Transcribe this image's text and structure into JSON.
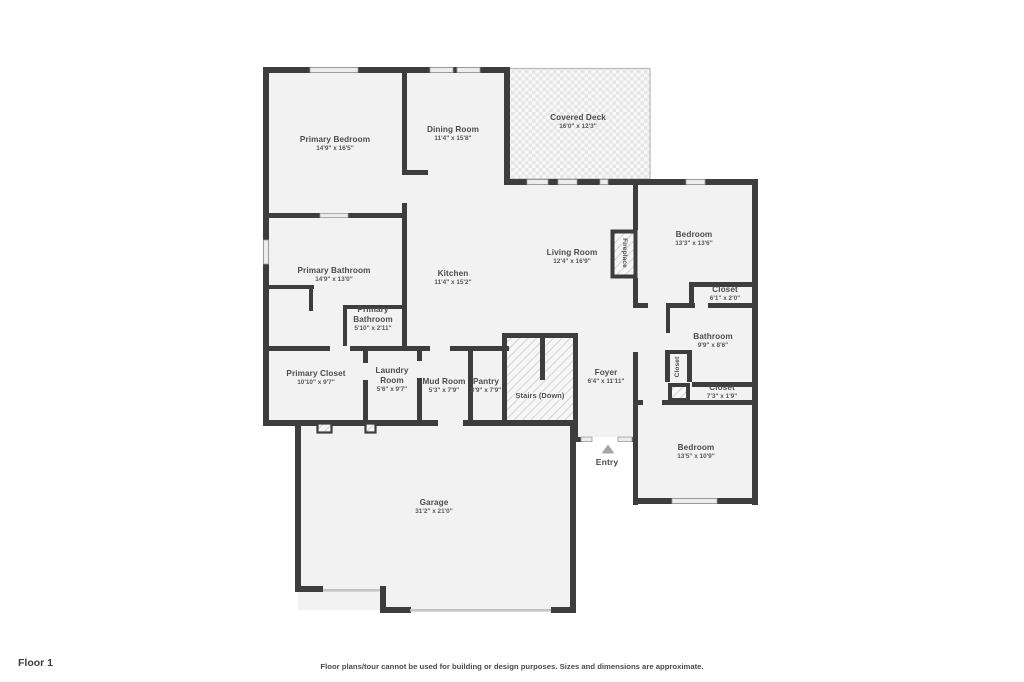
{
  "page": {
    "floor_label": "Floor 1",
    "disclaimer": "Floor plans/tour cannot be used for building or design purposes. Sizes and dimensions are approximate."
  },
  "colors": {
    "wall": "#3d3d3d",
    "room_fill": "#f2f2f2",
    "hatch_line": "#c9c9c9",
    "label_text": "#4c4c4c",
    "entry_arrow": "#a6a6a6"
  },
  "rooms": {
    "primary_bedroom": {
      "name": "Primary Bedroom",
      "dims": "14'9\" x 16'5\""
    },
    "dining_room": {
      "name": "Dining Room",
      "dims": "11'4\" x 15'8\""
    },
    "covered_deck": {
      "name": "Covered Deck",
      "dims": "16'0\" x 12'3\""
    },
    "bedroom_upper": {
      "name": "Bedroom",
      "dims": "13'3\" x 13'6\""
    },
    "living_room": {
      "name": "Living Room",
      "dims": "12'4\" x 16'9\""
    },
    "fireplace": {
      "name": "Fireplace"
    },
    "primary_bathroom": {
      "name": "Primary Bathroom",
      "dims": "14'9\" x 13'0\""
    },
    "kitchen": {
      "name": "Kitchen",
      "dims": "11'4\" x 15'2\""
    },
    "closet_upper": {
      "name": "Closet",
      "dims": "6'1\" x 2'0\""
    },
    "bathroom": {
      "name": "Bathroom",
      "dims": "9'9\" x 8'6\""
    },
    "primary_bathroom_small": {
      "name": "Primary Bathroom",
      "dims": "5'10\" x 2'11\""
    },
    "primary_closet": {
      "name": "Primary Closet",
      "dims": "10'10\" x 9'7\""
    },
    "laundry_room": {
      "name": "Laundry Room",
      "dims": "5'6\" x 9'7\""
    },
    "mud_room": {
      "name": "Mud Room",
      "dims": "5'3\" x 7'9\""
    },
    "pantry": {
      "name": "Pantry",
      "dims": "3'9\" x 7'9\""
    },
    "stairs": {
      "name": "Stairs (Down)"
    },
    "foyer": {
      "name": "Foyer",
      "dims": "6'4\" x 11'11\""
    },
    "closet_hall": {
      "name": "Closet"
    },
    "closet_lower": {
      "name": "Closet",
      "dims": "7'3\" x 1'9\""
    },
    "bedroom_lower": {
      "name": "Bedroom",
      "dims": "13'5\" x 10'9\""
    },
    "garage": {
      "name": "Garage",
      "dims": "31'2\" x 21'0\""
    },
    "entry": {
      "name": "Entry"
    }
  }
}
